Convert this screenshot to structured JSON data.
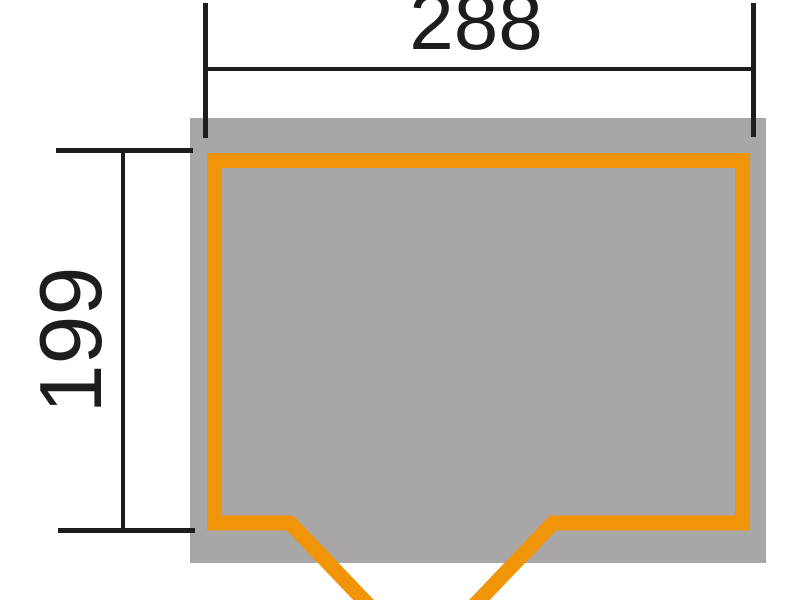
{
  "diagram": {
    "type": "shed-floor-plan-dimension-drawing",
    "dimensions": {
      "width_label": "288",
      "depth_label": "199"
    },
    "colors": {
      "background": "#FFFFFF",
      "footprint_gray": "#A8A6A6",
      "wall_orange": "#F09507",
      "dimension_black": "#1D1D1B"
    },
    "elements": {
      "footprint": "roof-overhang-footprint",
      "walls": "wall-outline",
      "door": "double-door-swing-open-v"
    }
  }
}
